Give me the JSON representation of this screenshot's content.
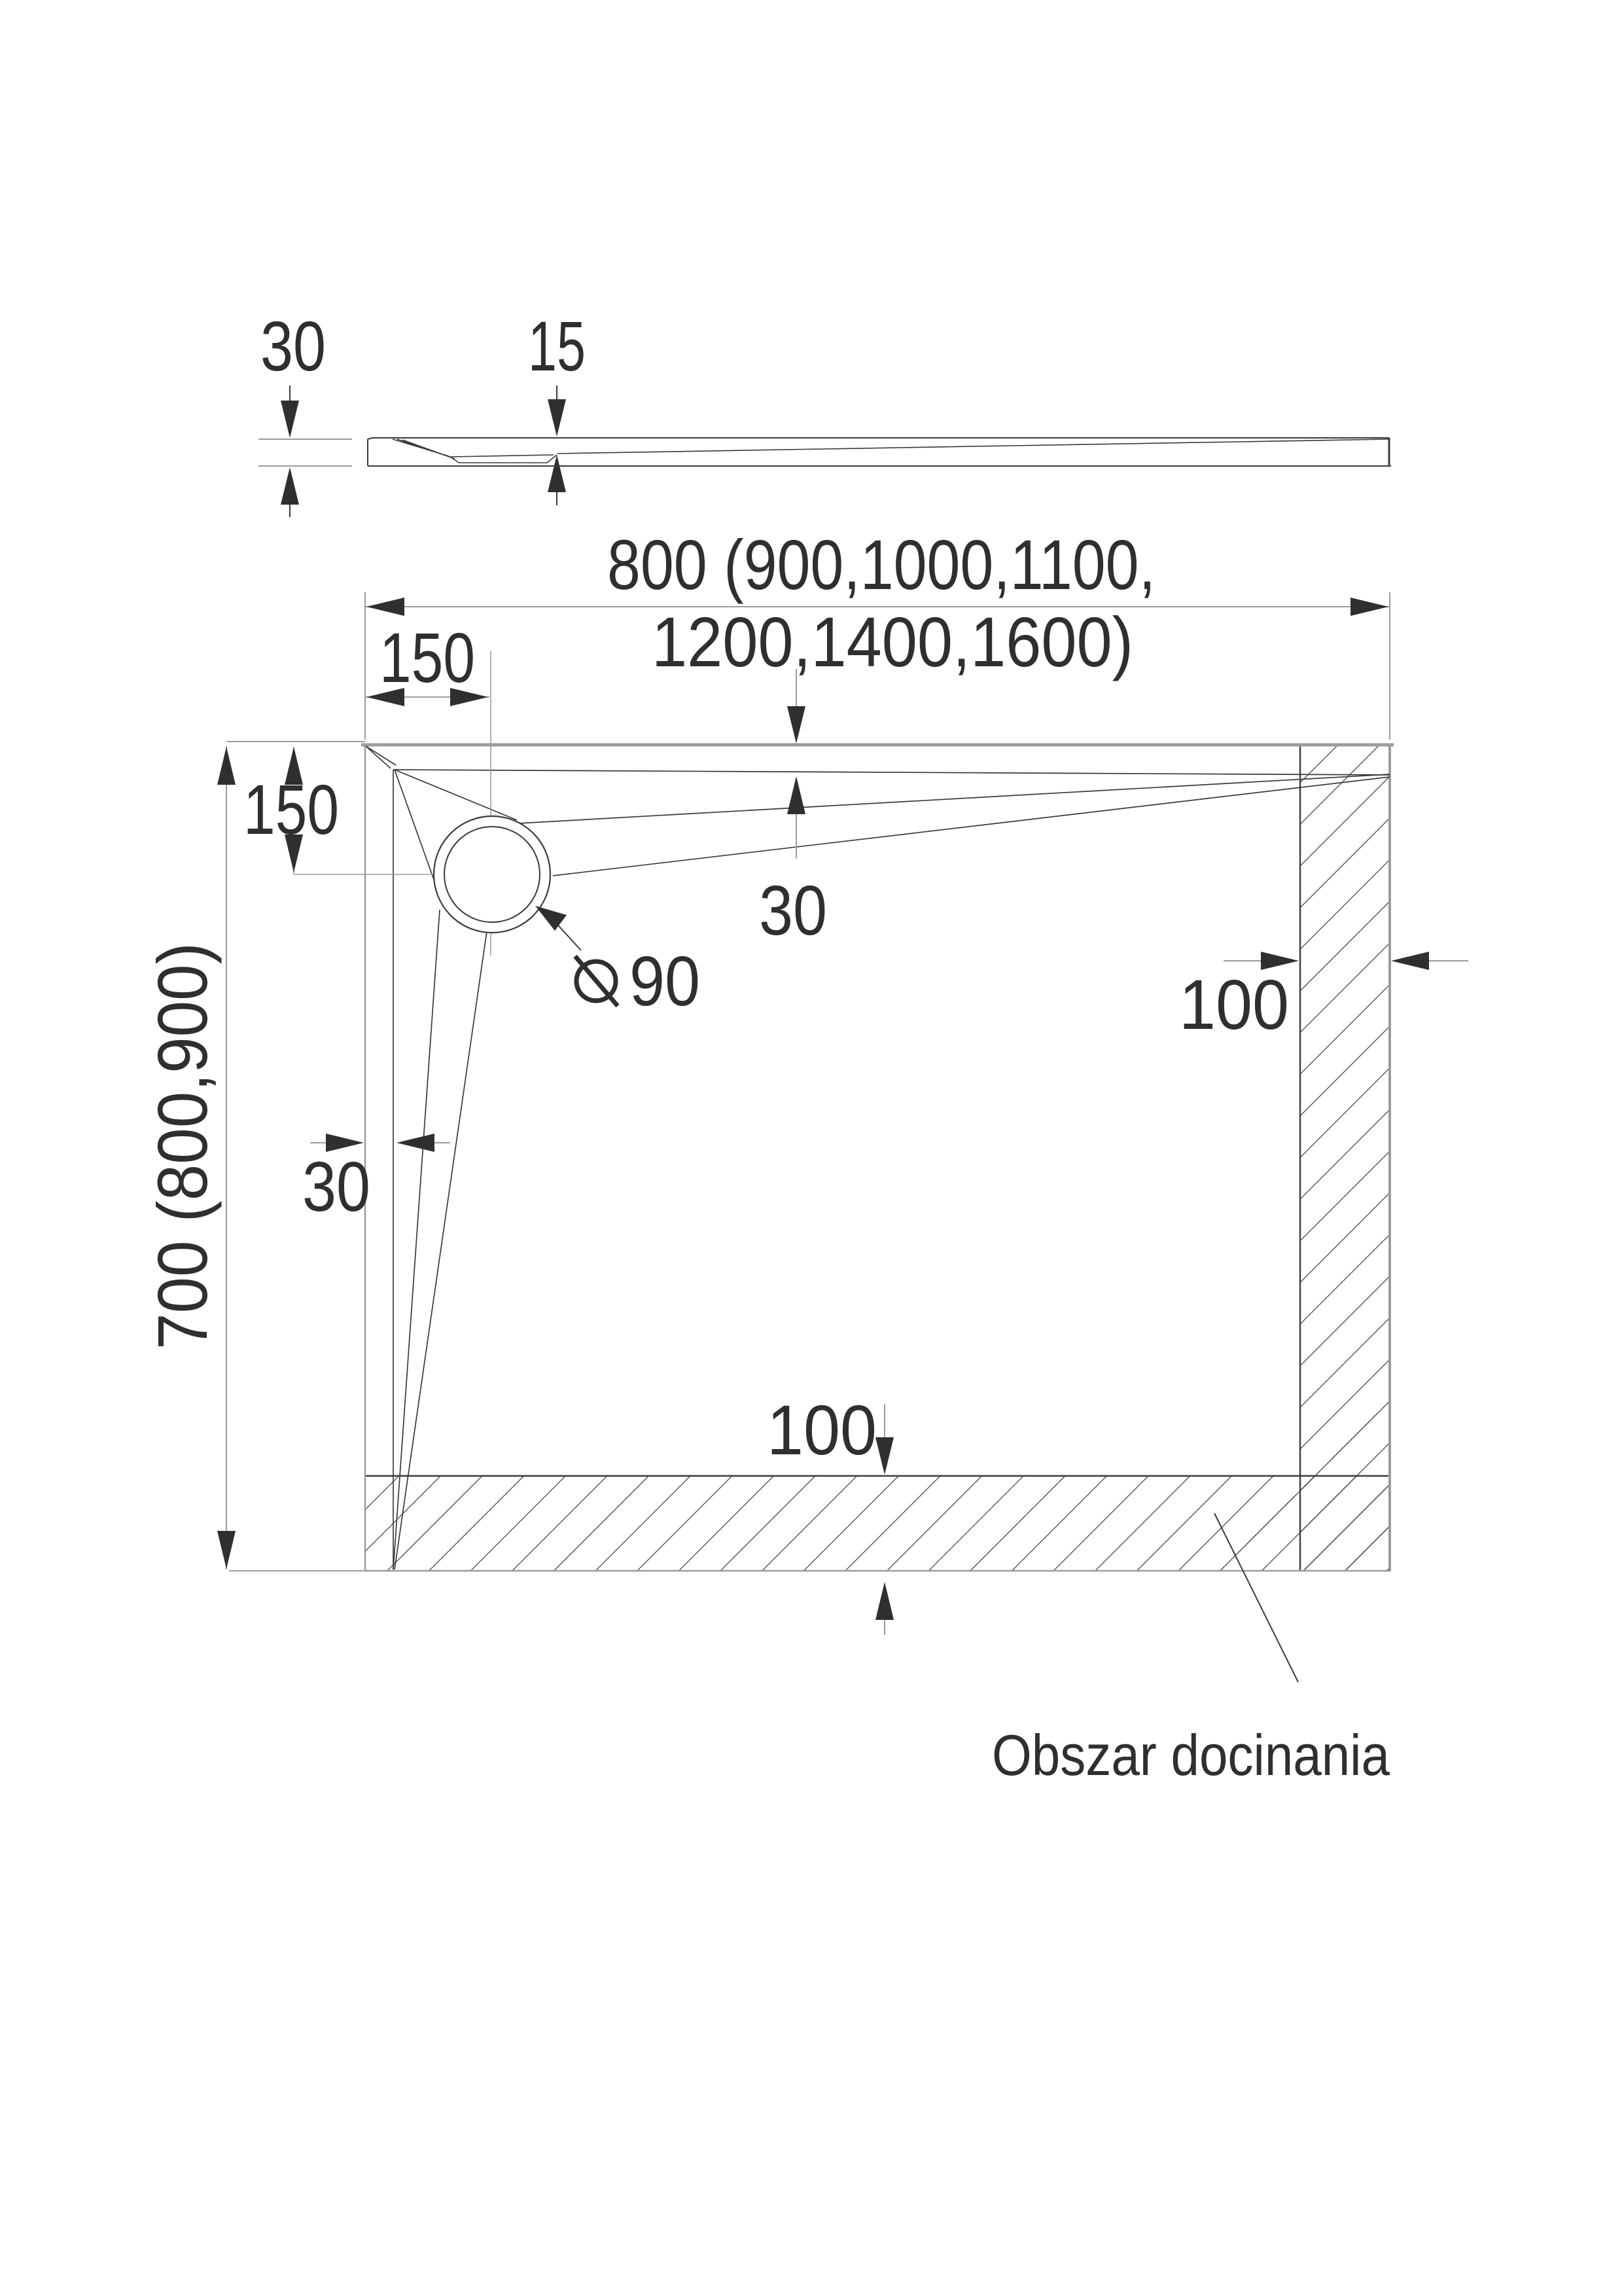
{
  "drawing": {
    "title_semantic": "shower-tray-dimension-drawing",
    "profile_view": {
      "thickness_label": "30",
      "inner_depth_label": "15"
    },
    "plan_view": {
      "width_label_line1": "800 (900,1000,1100,",
      "width_label_line2": "1200,1400,1600)",
      "height_label": "700 (800,900)",
      "drain_offset_horizontal_label": "150",
      "drain_offset_vertical_label": "150",
      "slope_offset_top_label": "30",
      "slope_offset_left_label": "30",
      "trim_band_right_label": "100",
      "trim_band_bottom_label": "100",
      "drain_diameter_value": "90",
      "trim_area_label": "Obszar docinania"
    }
  },
  "colors": {
    "background": "#ffffff",
    "construction_line": "#9c9c9c",
    "object_line": "#3a3a3a",
    "text": "#2f2f2f"
  }
}
